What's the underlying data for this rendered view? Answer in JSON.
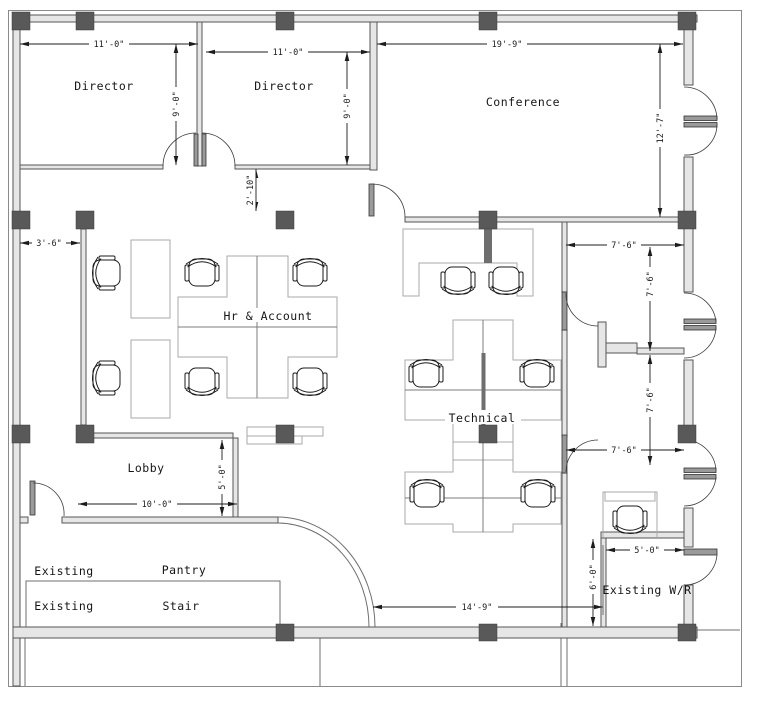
{
  "drawing": {
    "type": "office-floor-plan",
    "background": "#ffffff"
  },
  "rooms": {
    "director_1": "Director",
    "director_2": "Director",
    "conference": "Conference",
    "hr_account": "Hr & Account",
    "technical": "Technical",
    "lobby": "Lobby",
    "pantry_prefix": "Existing",
    "pantry": "Pantry",
    "stair_prefix": "Existing",
    "stair": "Stair",
    "washroom": "Existing W/R"
  },
  "dimensions": {
    "director_1_width": "11'-0\"",
    "director_2_width": "11'-0\"",
    "conference_width": "19'-9\"",
    "director_1_depth": "9'-0\"",
    "director_2_depth": "9'-0\"",
    "conference_depth": "12'-7\"",
    "hr_top_opening": "2'-10\"",
    "hr_left_offset": "3'-6\"",
    "room1_width": "7'-6\"",
    "room1_depth": "7'-6\"",
    "room2_depth": "7'-6\"",
    "room2_width": "7'-6\"",
    "lobby_corridor": "5'-0\"",
    "lobby_width": "10'-0\"",
    "wr_width": "5'-0\"",
    "wr_depth": "6'-0\"",
    "open_area_width": "14'-9\""
  },
  "colors": {
    "wall": "#565656",
    "wall_fill": "#e6e6e6",
    "column": "#595959",
    "furniture": "#a9a9a9",
    "dimension": "#1c1c1c",
    "text": "#161616",
    "background": "#ffffff"
  }
}
